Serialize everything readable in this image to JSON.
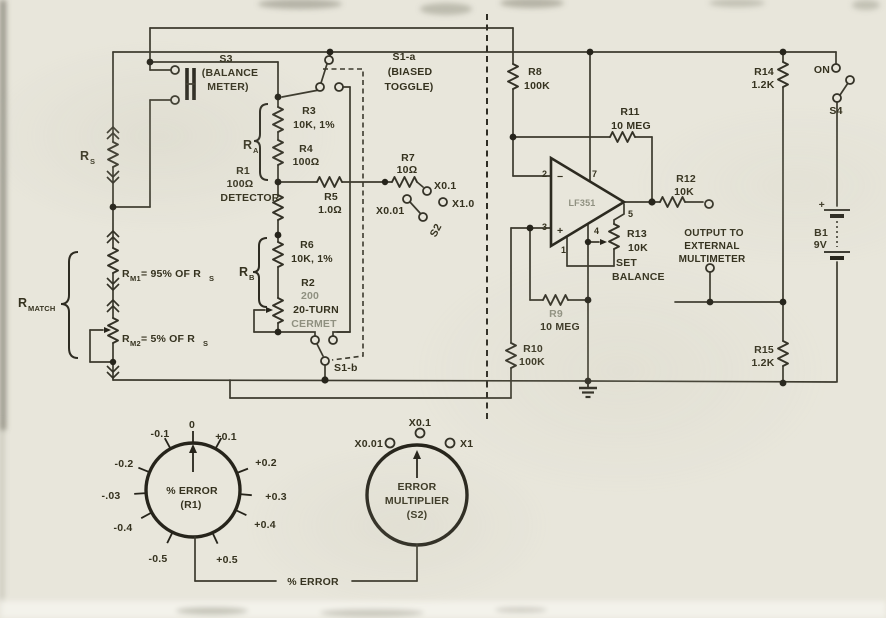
{
  "sch": {
    "s3": {
      "ref": "S3",
      "l1": "(BALANCE",
      "l2": "METER)"
    },
    "rs": {
      "r": "R",
      "sub": "S"
    },
    "rmatch": {
      "r": "R",
      "sub": "MATCH"
    },
    "rm1": {
      "r": "R",
      "sub": "M1",
      "eq": "= 95% OF R",
      "eqsub": "S"
    },
    "rm2": {
      "r": "R",
      "sub": "M2",
      "eq": "= 5% OF R",
      "eqsub": "S"
    },
    "r1": {
      "ref": "R1",
      "val": "100Ω",
      "note": "DETECTOR"
    },
    "ra": {
      "r": "R",
      "sub": "A"
    },
    "rb": {
      "r": "R",
      "sub": "B"
    },
    "r3": {
      "ref": "R3",
      "val": "10K, 1%"
    },
    "r4": {
      "ref": "R4",
      "val": "100Ω"
    },
    "r5": {
      "ref": "R5",
      "val": "1.0Ω"
    },
    "r6": {
      "ref": "R6",
      "val": "10K, 1%"
    },
    "r2": {
      "ref": "R2",
      "val": "200",
      "n1": "20-TURN",
      "n2": "CERMET"
    },
    "r7": {
      "ref": "R7",
      "val": "10Ω"
    },
    "r8": {
      "ref": "R8",
      "val": "100K"
    },
    "r9": {
      "ref": "R9",
      "val": "10 MEG"
    },
    "r10": {
      "ref": "R10",
      "val": "100K"
    },
    "r11": {
      "ref": "R11",
      "val": "10 MEG"
    },
    "r12": {
      "ref": "R12",
      "val": "10K"
    },
    "r13": {
      "ref": "R13",
      "val": "10K",
      "n1": "SET",
      "n2": "BALANCE"
    },
    "r14": {
      "ref": "R14",
      "val": "1.2K"
    },
    "r15": {
      "ref": "R15",
      "val": "1.2K"
    },
    "s1a": {
      "ref": "S1-a",
      "l1": "(BIASED",
      "l2": "TOGGLE)"
    },
    "s1b": {
      "ref": "S1-b"
    },
    "s2": {
      "ref": "S2"
    },
    "s4": {
      "ref": "S4",
      "on": "ON"
    },
    "mult": {
      "x01": "X0.1",
      "x001": "X0.01",
      "x10": "X1.0"
    },
    "b1": {
      "ref": "B1",
      "val": "9V",
      "plus": "+"
    },
    "opamp": {
      "part": "LF351",
      "pin1": "1",
      "pin2": "2",
      "pin3": "3",
      "pin4": "4",
      "pin5": "5",
      "pin7": "7",
      "minus": "−",
      "plus": "+"
    },
    "output": {
      "l1": "OUTPUT TO",
      "l2": "EXTERNAL",
      "l3": "MULTIMETER"
    }
  },
  "dials": {
    "error": {
      "l1": "% ERROR",
      "l2": "(R1)",
      "scale": [
        "0",
        "+0.1",
        "+0.2",
        "+0.3",
        "+0.4",
        "+0.5",
        "-0.1",
        "-0.2",
        "-.03",
        "-0.4",
        "-0.5"
      ]
    },
    "mult": {
      "l1": "ERROR",
      "l2": "MULTIPLIER",
      "l3": "(S2)",
      "pos": [
        "X0.01",
        "X0.1",
        "X1"
      ]
    },
    "footer": "% ERROR"
  },
  "colors": {
    "paper": "#e8e6db",
    "ink": "#3a382c",
    "faded": "#8f9080"
  }
}
